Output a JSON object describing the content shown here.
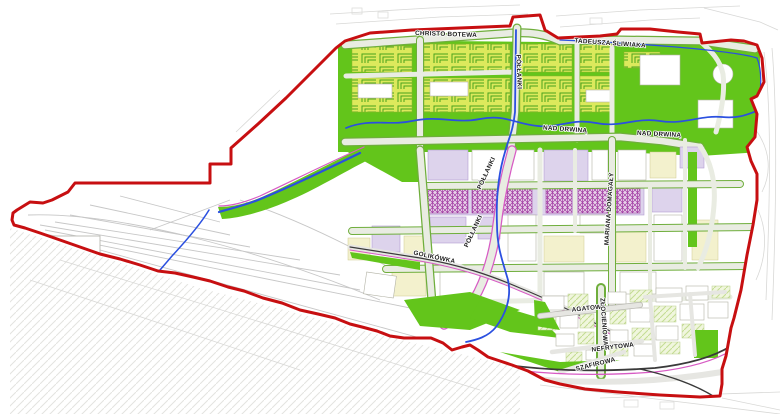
{
  "map": {
    "title": "urban-development-plan-map",
    "street_labels": [
      {
        "id": "christo-botewa",
        "text": "CHRISTO BOTEWA",
        "x": 446,
        "y": 36,
        "rot": 2
      },
      {
        "id": "tadeusza-sliwiaka",
        "text": "TADEUSZA ŚLIWIAKA",
        "x": 610,
        "y": 45,
        "rot": 4
      },
      {
        "id": "pollanki-north",
        "text": "PÓŁŁANKI",
        "x": 517,
        "y": 72,
        "rot": 88
      },
      {
        "id": "nad-drwina-west",
        "text": "NAD DRWINĄ",
        "x": 565,
        "y": 131,
        "rot": 4
      },
      {
        "id": "nad-drwina-east",
        "text": "NAD DRWINĄ",
        "x": 659,
        "y": 136,
        "rot": 3
      },
      {
        "id": "pollanki-mid",
        "text": "PÓŁŁANKI",
        "x": 488,
        "y": 174,
        "rot": -65
      },
      {
        "id": "pollanki-south",
        "text": "PÓŁŁANKI",
        "x": 475,
        "y": 232,
        "rot": -65
      },
      {
        "id": "mariana-domagaly",
        "text": "MARIANA DOMAGAŁY",
        "x": 611,
        "y": 209,
        "rot": -86
      },
      {
        "id": "golikowka",
        "text": "GOLIKÓWKA",
        "x": 434,
        "y": 259,
        "rot": 12
      },
      {
        "id": "agatowa",
        "text": "AGATOWA",
        "x": 589,
        "y": 310,
        "rot": -6
      },
      {
        "id": "zlocieniowa",
        "text": "ZŁOCIENIOWA",
        "x": 602,
        "y": 322,
        "rot": 86
      },
      {
        "id": "nefrytowa",
        "text": "NEFRYTOWA",
        "x": 613,
        "y": 349,
        "rot": -7
      },
      {
        "id": "szafirowa",
        "text": "SZAFIROWA",
        "x": 596,
        "y": 366,
        "rot": -14
      }
    ],
    "colors": {
      "boundary": "#c70f11",
      "green": "#63c51b",
      "garden_fill": "#dce95c",
      "garden_hatch": "#49a31d",
      "cream": "#f3f1cd",
      "lavender": "#ddd3ec",
      "lavender_edge": "#b29dd0",
      "purple_hatch": "#a23ba3",
      "water": "#2b50e0",
      "magenta": "#d75bc4",
      "rail": "#3a3a3a",
      "faint": "#d8d8d6",
      "label": "#1c1c1c"
    }
  }
}
